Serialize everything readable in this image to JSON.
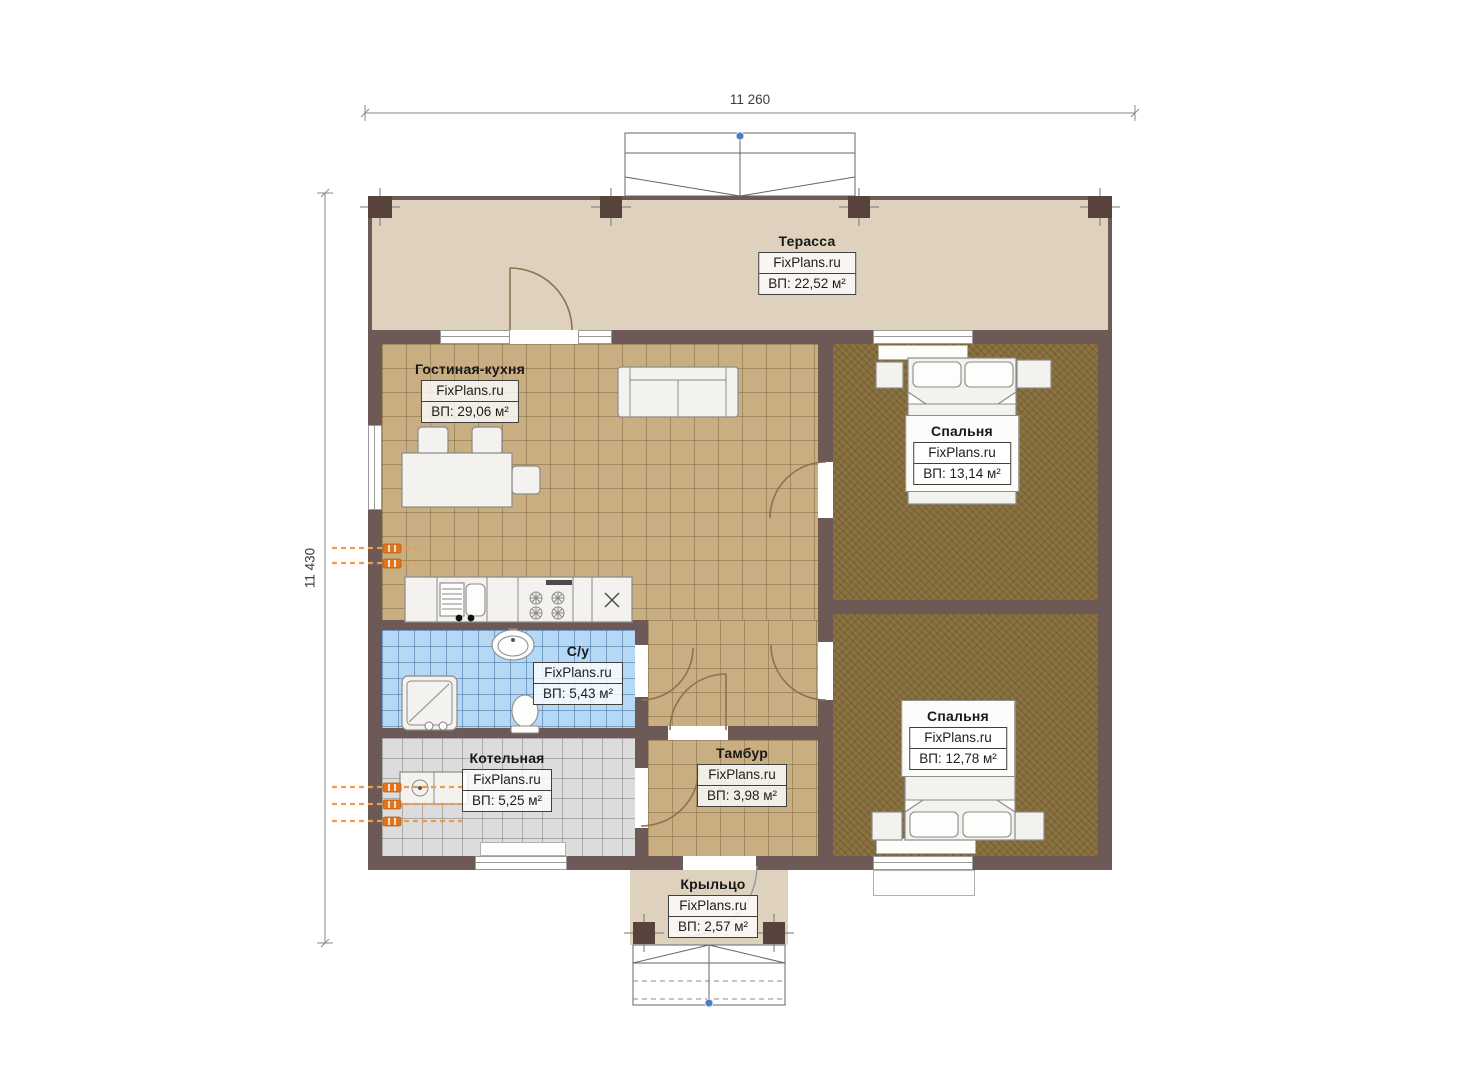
{
  "brand": "FixPlans.ru",
  "dimensions": {
    "top": "11 260",
    "left": "11 430"
  },
  "rooms": {
    "terrace": {
      "name": "Терасса",
      "brand": "FixPlans.ru",
      "area": "ВП: 22,52 м²"
    },
    "living": {
      "name": "Гостиная-кухня",
      "brand": "FixPlans.ru",
      "area": "ВП: 29,06 м²"
    },
    "bedroom1": {
      "name": "Спальня",
      "brand": "FixPlans.ru",
      "area": "ВП: 13,14 м²"
    },
    "bathroom": {
      "name": "С/у",
      "brand": "FixPlans.ru",
      "area": "ВП: 5,43 м²"
    },
    "boiler": {
      "name": "Котельная",
      "brand": "FixPlans.ru",
      "area": "ВП: 5,25 м²"
    },
    "tambour": {
      "name": "Тамбур",
      "brand": "FixPlans.ru",
      "area": "ВП: 3,98 м²"
    },
    "bedroom2": {
      "name": "Спальня",
      "brand": "FixPlans.ru",
      "area": "ВП: 12,78 м²"
    },
    "porch": {
      "name": "Крыльцо",
      "brand": "FixPlans.ru",
      "area": "ВП: 2,57 м²"
    }
  },
  "colors": {
    "wall": "#6d5a56",
    "pillar": "#57433c",
    "terrace-floor": "#ded2be",
    "tile-floor": "#c8ae81",
    "bedroom-floor": "#8c7342",
    "bath-floor": "#b5d8f4",
    "boiler-floor": "#dcdcdc",
    "radiator": "#e0731c",
    "radiator-line": "#ef9a4a",
    "door-arc": "#8a7350",
    "accent-dot": "#4a7fc3",
    "dim-line": "#8a8a8a",
    "label-border": "#3f3f3f"
  }
}
